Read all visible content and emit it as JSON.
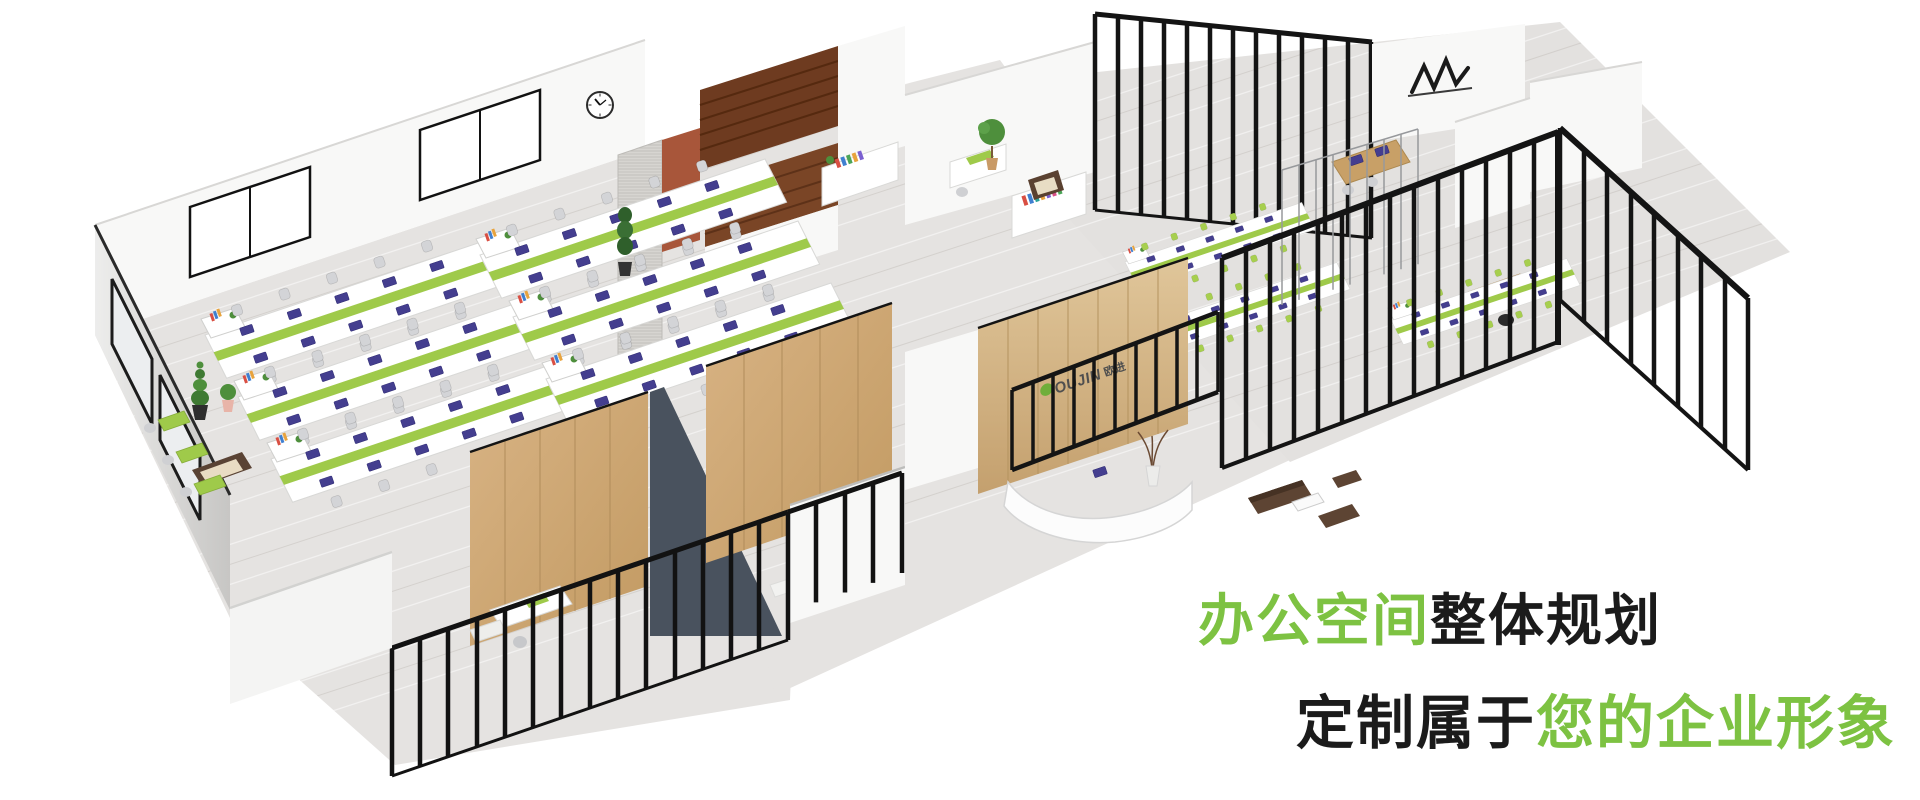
{
  "headline": {
    "line1": {
      "highlight": "办公空间",
      "rest": "整体规划"
    },
    "line2": {
      "lead": "定制属于",
      "highlight": "您的企业形象"
    }
  },
  "reception_logo": {
    "latin": "OUJIN",
    "cjk": "欧进"
  },
  "colors": {
    "accent_green": "#7dc242",
    "headline_dark": "#1b1b1b",
    "desk_divider_green": "#9fca4a",
    "lime_chair": "#a7cf4e",
    "floor_grey": "#e5e3e1",
    "wall_white": "#f8f8f7",
    "oak_wood": "#cfa976",
    "walnut_wood": "#6e3b20",
    "reception_wood": "#d7b98b",
    "slate_partition": "#49525e",
    "railing_black": "#141414",
    "sofa_brown": "#5d4433",
    "screen_purple": "#443e8f",
    "plant_green": "#4e8f3c",
    "logo_leaf_green": "#6fae3a"
  }
}
